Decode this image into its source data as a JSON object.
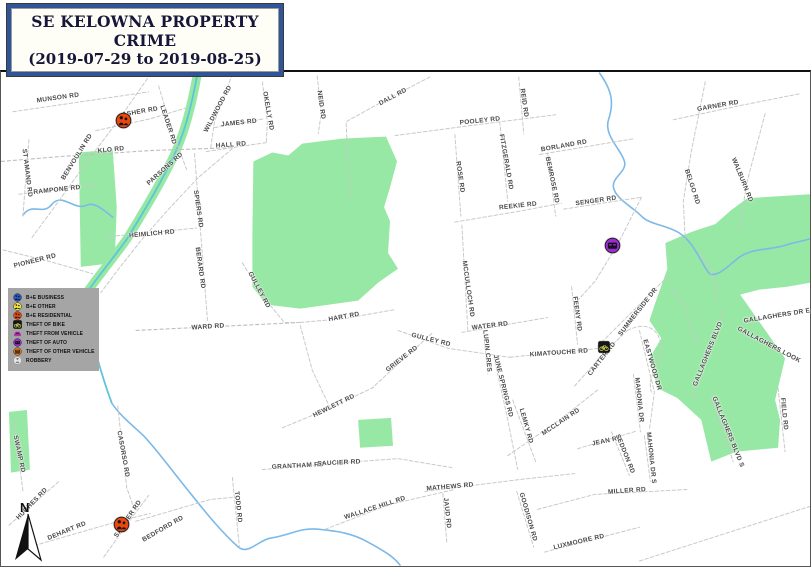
{
  "title": {
    "line1": "SE KELOWNA PROPERTY CRIME",
    "line2": "(2019-07-29 to 2019-08-25)"
  },
  "colors": {
    "park_green": "#97e8a4",
    "creek_blue": "#7cb9e8",
    "creek_teal": "#5fc4da",
    "road_gray": "#c9c9c9",
    "label_gray": "#4a4a4a",
    "legend_bg": "#a5a5a5",
    "title_border": "#2f5597",
    "title_text": "#16163a"
  },
  "legend": {
    "items": [
      {
        "id": "be-business",
        "label": "B+E BUSINESS",
        "icon": "icon-person-circle",
        "color": "#2857c8"
      },
      {
        "id": "be-other",
        "label": "B+E OTHER",
        "icon": "icon-person-circle",
        "color": "#f0e63c"
      },
      {
        "id": "be-residential",
        "label": "B+E RESIDENTIAL",
        "icon": "icon-person-circle",
        "color": "#e8470e"
      },
      {
        "id": "theft-of-bike",
        "label": "THEFT OF BIKE",
        "icon": "icon-bike-square",
        "color": "#cfd64e"
      },
      {
        "id": "theft-from-vehicle",
        "label": "THEFT FROM VEHICLE",
        "icon": "icon-vehicle-pink",
        "color": "#e23bd0"
      },
      {
        "id": "theft-of-auto",
        "label": "THEFT OF AUTO",
        "icon": "icon-car-circle",
        "color": "#9c2bd6"
      },
      {
        "id": "theft-of-other-vehicle",
        "label": "THEFT OF OTHER VEHICLE",
        "icon": "icon-truck-circle",
        "color": "#ed7d1c"
      },
      {
        "id": "robbery",
        "label": "ROBBERY",
        "icon": "icon-robbery-circle",
        "color": "#e3e3e3"
      }
    ]
  },
  "map": {
    "north_label": "N",
    "markers": [
      {
        "type": "be-residential",
        "label": "B+E RESIDENTIAL",
        "icon": "icon-person-circle",
        "color": "#e8470e",
        "x": 122,
        "y": 118,
        "size": 17
      },
      {
        "type": "theft-of-auto",
        "label": "THEFT OF AUTO",
        "icon": "icon-car-circle",
        "color": "#9c2bd6",
        "x": 611,
        "y": 243,
        "size": 17
      },
      {
        "type": "theft-of-bike",
        "label": "THEFT OF BIKE",
        "icon": "icon-bike-square",
        "color": "#cfd64e",
        "x": 603,
        "y": 345,
        "size": 12
      },
      {
        "type": "be-residential",
        "label": "B+E RESIDENTIAL",
        "icon": "icon-person-circle",
        "color": "#e8470e",
        "x": 120,
        "y": 522,
        "size": 17
      }
    ],
    "road_labels": [
      {
        "text": "MUNSON RD",
        "x": 57,
        "y": 96,
        "r": -8
      },
      {
        "text": "ASHER RD",
        "x": 139,
        "y": 110,
        "r": -10
      },
      {
        "text": "LEADER RD",
        "x": 167,
        "y": 123,
        "r": 72
      },
      {
        "text": "KLO RD",
        "x": 110,
        "y": 148,
        "r": -6
      },
      {
        "text": "BENVOULIN RD",
        "x": 76,
        "y": 155,
        "r": -58
      },
      {
        "text": "ST AMAND RD",
        "x": 26,
        "y": 171,
        "r": 83
      },
      {
        "text": "RAMPONE RD",
        "x": 56,
        "y": 188,
        "r": -6
      },
      {
        "text": "PIONEER RD",
        "x": 34,
        "y": 259,
        "r": -14
      },
      {
        "text": "PARSONS RD",
        "x": 164,
        "y": 167,
        "r": -42
      },
      {
        "text": "WILDWOOD RD",
        "x": 217,
        "y": 107,
        "r": -62
      },
      {
        "text": "JAMES RD",
        "x": 238,
        "y": 121,
        "r": -6
      },
      {
        "text": "HALL RD",
        "x": 230,
        "y": 143,
        "r": -4
      },
      {
        "text": "OKELLY RD",
        "x": 267,
        "y": 109,
        "r": 80
      },
      {
        "text": "NEID RD",
        "x": 320,
        "y": 103,
        "r": 82
      },
      {
        "text": "SPIERS RD",
        "x": 197,
        "y": 207,
        "r": 82
      },
      {
        "text": "HEIMLICH RD",
        "x": 151,
        "y": 232,
        "r": -5
      },
      {
        "text": "BERARD RD",
        "x": 199,
        "y": 266,
        "r": 82
      },
      {
        "text": "DALL RD",
        "x": 392,
        "y": 95,
        "r": -28
      },
      {
        "text": "POOLEY RD",
        "x": 479,
        "y": 119,
        "r": -6
      },
      {
        "text": "REID RD",
        "x": 523,
        "y": 101,
        "r": 82
      },
      {
        "text": "ROSE RD",
        "x": 459,
        "y": 175,
        "r": 82
      },
      {
        "text": "FITZGERALD RD",
        "x": 505,
        "y": 160,
        "r": 80
      },
      {
        "text": "REEKIE RD",
        "x": 517,
        "y": 204,
        "r": -6
      },
      {
        "text": "BORLAND RD",
        "x": 563,
        "y": 144,
        "r": -10
      },
      {
        "text": "BEMROSE RD",
        "x": 551,
        "y": 178,
        "r": 78
      },
      {
        "text": "SENGER RD",
        "x": 595,
        "y": 199,
        "r": -8
      },
      {
        "text": "GARNER RD",
        "x": 717,
        "y": 104,
        "r": -10
      },
      {
        "text": "BELGO RD",
        "x": 691,
        "y": 185,
        "r": 72
      },
      {
        "text": "WALBURN RD",
        "x": 741,
        "y": 178,
        "r": 68
      },
      {
        "text": "GULLEY RD",
        "x": 258,
        "y": 288,
        "r": 62
      },
      {
        "text": "WARD RD",
        "x": 207,
        "y": 325,
        "r": -4
      },
      {
        "text": "HART RD",
        "x": 343,
        "y": 315,
        "r": -10
      },
      {
        "text": "GULLEY RD",
        "x": 430,
        "y": 338,
        "r": 14
      },
      {
        "text": "MCCULLOCH RD",
        "x": 467,
        "y": 287,
        "r": 82
      },
      {
        "text": "WATER RD",
        "x": 489,
        "y": 324,
        "r": -7
      },
      {
        "text": "GRIEVE RD",
        "x": 401,
        "y": 357,
        "r": -38
      },
      {
        "text": "LUPIN CRES",
        "x": 486,
        "y": 349,
        "r": 84
      },
      {
        "text": "JUNE SPRINGS RD",
        "x": 502,
        "y": 384,
        "r": 76
      },
      {
        "text": "KIMATOUCHE RD",
        "x": 558,
        "y": 351,
        "r": -4
      },
      {
        "text": "FEENY RD",
        "x": 576,
        "y": 312,
        "r": 82
      },
      {
        "text": "CARTER RD",
        "x": 601,
        "y": 357,
        "r": -52
      },
      {
        "text": "SUMMERSIDE DR",
        "x": 637,
        "y": 310,
        "r": -52
      },
      {
        "text": "EASTWOOD DR",
        "x": 651,
        "y": 363,
        "r": 74
      },
      {
        "text": "MAHONIA DR",
        "x": 638,
        "y": 398,
        "r": 84
      },
      {
        "text": "HEWLETT RD",
        "x": 333,
        "y": 404,
        "r": -26
      },
      {
        "text": "GALLAGHERS DR E",
        "x": 776,
        "y": 314,
        "r": -9
      },
      {
        "text": "GALLAGHERS LOOK",
        "x": 768,
        "y": 343,
        "r": 28
      },
      {
        "text": "GALLAGHERS BLVD",
        "x": 707,
        "y": 352,
        "r": -68
      },
      {
        "text": "GALLAGHERS BLVD S",
        "x": 727,
        "y": 430,
        "r": 68
      },
      {
        "text": "FIELD RD",
        "x": 783,
        "y": 412,
        "r": 84
      },
      {
        "text": "SWAMP RD",
        "x": 18,
        "y": 452,
        "r": 78
      },
      {
        "text": "CASORSO RD",
        "x": 122,
        "y": 452,
        "r": 80
      },
      {
        "text": "HUGHES RD",
        "x": 31,
        "y": 502,
        "r": -46
      },
      {
        "text": "DEHART RD",
        "x": 66,
        "y": 529,
        "r": -22
      },
      {
        "text": "SAUCIER RD",
        "x": 127,
        "y": 517,
        "r": -56
      },
      {
        "text": "BEDFORD RD",
        "x": 162,
        "y": 527,
        "r": -30
      },
      {
        "text": "TODD RD",
        "x": 237,
        "y": 505,
        "r": 84
      },
      {
        "text": "GRANTHAM RD",
        "x": 297,
        "y": 464,
        "r": -3
      },
      {
        "text": "SAUCIER RD",
        "x": 338,
        "y": 461,
        "r": -3
      },
      {
        "text": "WALLACE HILL RD",
        "x": 374,
        "y": 506,
        "r": -18
      },
      {
        "text": "MATHEWS RD",
        "x": 449,
        "y": 485,
        "r": -5
      },
      {
        "text": "JAUD RD",
        "x": 446,
        "y": 511,
        "r": 84
      },
      {
        "text": "GOODISON RD",
        "x": 527,
        "y": 515,
        "r": 74
      },
      {
        "text": "LEMKY RD",
        "x": 525,
        "y": 424,
        "r": 74
      },
      {
        "text": "MCCLAIN RD",
        "x": 560,
        "y": 420,
        "r": -34
      },
      {
        "text": "JEAN RD",
        "x": 606,
        "y": 439,
        "r": -12
      },
      {
        "text": "SEDDON RD",
        "x": 624,
        "y": 452,
        "r": 68
      },
      {
        "text": "MAHONIA DR S",
        "x": 650,
        "y": 456,
        "r": 84
      },
      {
        "text": "MILLER RD",
        "x": 626,
        "y": 489,
        "r": -4
      },
      {
        "text": "LUXMOORE RD",
        "x": 578,
        "y": 540,
        "r": -13
      },
      {
        "text": "WARD RD",
        "x": 207,
        "y": 325,
        "r": -4
      }
    ]
  }
}
